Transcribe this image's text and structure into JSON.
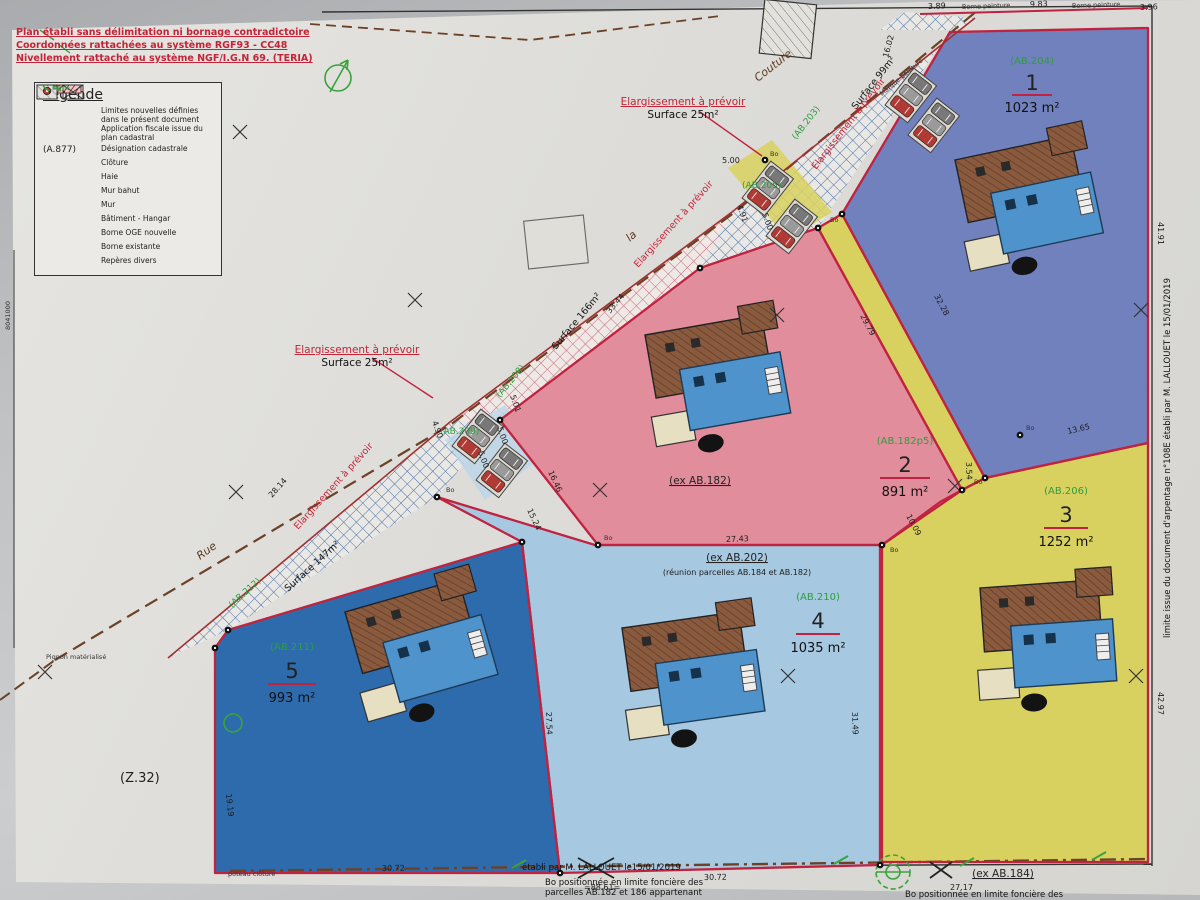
{
  "notes": {
    "line1": "Plan établi sans délimitation ni bornage contradictoire",
    "line2": "Coordonnées rattachées au système RGF93  -  CC48",
    "line3": "Nivellement rattaché au système NGF/I.G.N 69. (TERIA)"
  },
  "legend": {
    "title": "Légende",
    "items": [
      {
        "label": "Limites nouvelles définies dans le présent document"
      },
      {
        "label": "Application fiscale issue du plan cadastral"
      },
      {
        "label": "Désignation cadastrale",
        "sym": "(A.877)"
      },
      {
        "label": "Clôture"
      },
      {
        "label": "Haie"
      },
      {
        "label": "Mur bahut"
      },
      {
        "label": "Mur"
      },
      {
        "label": "Bâtiment - Hangar"
      },
      {
        "label": "Borne OGE nouvelle",
        "tag": "Bo"
      },
      {
        "label": "Borne existante",
        "tag": "Borne"
      },
      {
        "label": "Repères divers"
      }
    ]
  },
  "ann_top": {
    "line1": "Elargissement à prévoir",
    "line2": "Surface 25m²"
  },
  "ann_left": {
    "line1": "Elargissement à prévoir",
    "line2": "Surface 25m²"
  },
  "parcels": [
    {
      "ref": "(AB.204)",
      "num": "1",
      "area": "1023 m²"
    },
    {
      "ref": "(AB.182p5)",
      "num": "2",
      "area": "891 m²"
    },
    {
      "ref": "(AB.206)",
      "num": "3",
      "area": "1252 m²"
    },
    {
      "ref": "(AB.210)",
      "num": "4",
      "area": "1035 m²"
    },
    {
      "ref": "(AB.211)",
      "num": "5",
      "area": "993 m²"
    }
  ],
  "ex": {
    "ab182": "(ex AB.182)",
    "ab202": "(ex AB.202)",
    "ab202b": "(réunion parcelles AB.184 et AB.182)",
    "ab184": "(ex AB.184)"
  },
  "zone_label": "(Z.32)",
  "side_note": "limite issue du document d'arpentage n°108E établi par M. LALLOUET le 15/01/2019",
  "bottom": {
    "strike": "établi par M. LALLOUET le15/01/2019",
    "note1a": "Bo positionnée en limite foncière des",
    "note1b": "parcelles AB.182 et 186 appartenant",
    "note2": "Bo positionnée en limite foncière des"
  },
  "colors": {
    "parcel1": "#7081bd",
    "parcel2": "#e18d9c",
    "parcel3": "#d9d15f",
    "parcel4": "#a6c8e0",
    "parcel5": "#2e6bac",
    "new_limit_red": "#bf2340",
    "green_ref": "#2e9e3e",
    "road_brown": "#6b4226"
  },
  "labels": [
    {
      "t": "3.89",
      "x": 928,
      "y": 9,
      "r": -2,
      "c": "d"
    },
    {
      "t": "9.83",
      "x": 1030,
      "y": 7,
      "r": -2,
      "c": "d"
    },
    {
      "t": "3.96",
      "x": 1140,
      "y": 10,
      "r": -2,
      "c": "d"
    },
    {
      "t": "Borne peinture",
      "x": 962,
      "y": 9,
      "r": -2,
      "c": "t"
    },
    {
      "t": "Borne peinture",
      "x": 1072,
      "y": 8,
      "r": -2,
      "c": "t"
    },
    {
      "t": "16.02",
      "x": 888,
      "y": 58,
      "r": -75,
      "c": "d"
    },
    {
      "t": "41.91",
      "x": 1158,
      "y": 222,
      "r": 90,
      "c": "d"
    },
    {
      "t": "Marque peinture",
      "x": 882,
      "y": 96,
      "r": -40,
      "c": "t"
    },
    {
      "t": "Surface 99m²",
      "x": 856,
      "y": 110,
      "r": -52,
      "c": "s"
    },
    {
      "t": "(AB.203)",
      "x": 796,
      "y": 140,
      "r": -52,
      "c": "g"
    },
    {
      "t": "Elargissement à prévoir",
      "x": 816,
      "y": 170,
      "r": -52,
      "c": "r"
    },
    {
      "t": "(AB.205)",
      "x": 742,
      "y": 188,
      "r": 0,
      "c": "g"
    },
    {
      "t": "5.00",
      "x": 722,
      "y": 163,
      "r": 0,
      "c": "d"
    },
    {
      "t": "4.91",
      "x": 737,
      "y": 206,
      "r": 70,
      "c": "d"
    },
    {
      "t": "5.00",
      "x": 762,
      "y": 214,
      "r": 70,
      "c": "d"
    },
    {
      "t": "Couture",
      "x": 758,
      "y": 82,
      "r": -38,
      "c": "b"
    },
    {
      "t": "la",
      "x": 630,
      "y": 242,
      "r": -42,
      "c": "b"
    },
    {
      "t": "Rue",
      "x": 200,
      "y": 560,
      "r": -36,
      "c": "b"
    },
    {
      "t": "Elargissement à prévoir",
      "x": 638,
      "y": 268,
      "r": -48,
      "c": "r"
    },
    {
      "t": "33.44",
      "x": 610,
      "y": 314,
      "r": -50,
      "c": "d"
    },
    {
      "t": "Surface 166m²",
      "x": 556,
      "y": 350,
      "r": -50,
      "c": "s"
    },
    {
      "t": "(AB.208)",
      "x": 500,
      "y": 398,
      "r": -50,
      "c": "g"
    },
    {
      "t": "5.01",
      "x": 510,
      "y": 396,
      "r": 70,
      "c": "d"
    },
    {
      "t": "5.00",
      "x": 497,
      "y": 428,
      "r": 70,
      "c": "d"
    },
    {
      "t": "(AB.209)",
      "x": 440,
      "y": 434,
      "r": 0,
      "c": "g"
    },
    {
      "t": "4.90",
      "x": 432,
      "y": 422,
      "r": 70,
      "c": "d"
    },
    {
      "t": "5.00",
      "x": 478,
      "y": 452,
      "r": 70,
      "c": "d"
    },
    {
      "t": "28.14",
      "x": 272,
      "y": 498,
      "r": -48,
      "c": "d"
    },
    {
      "t": "Elargissement à prévoir",
      "x": 298,
      "y": 530,
      "r": -48,
      "c": "r"
    },
    {
      "t": "Surface 147m²",
      "x": 288,
      "y": 592,
      "r": -42,
      "c": "s"
    },
    {
      "t": "(AB.212)",
      "x": 232,
      "y": 608,
      "r": -42,
      "c": "g"
    },
    {
      "t": "16.46",
      "x": 548,
      "y": 472,
      "r": 65,
      "c": "d"
    },
    {
      "t": "15.24",
      "x": 527,
      "y": 510,
      "r": 65,
      "c": "d"
    },
    {
      "t": "29.79",
      "x": 860,
      "y": 316,
      "r": 62,
      "c": "d"
    },
    {
      "t": "32.28",
      "x": 934,
      "y": 296,
      "r": 62,
      "c": "d"
    },
    {
      "t": "3.54",
      "x": 966,
      "y": 462,
      "r": 88,
      "c": "d"
    },
    {
      "t": "10.09",
      "x": 906,
      "y": 516,
      "r": 62,
      "c": "d"
    },
    {
      "t": "13.65",
      "x": 1068,
      "y": 434,
      "r": -13,
      "c": "d"
    },
    {
      "t": "27.43",
      "x": 726,
      "y": 542,
      "r": -2,
      "c": "d"
    },
    {
      "t": "31.49",
      "x": 852,
      "y": 712,
      "r": 88,
      "c": "d"
    },
    {
      "t": "27.54",
      "x": 546,
      "y": 712,
      "r": 88,
      "c": "d"
    },
    {
      "t": "42.97",
      "x": 1158,
      "y": 692,
      "r": 90,
      "c": "d"
    },
    {
      "t": "19.19",
      "x": 226,
      "y": 794,
      "r": 84,
      "c": "d"
    },
    {
      "t": "30.72",
      "x": 382,
      "y": 871,
      "r": -1,
      "c": "d"
    },
    {
      "t": "30.72",
      "x": 704,
      "y": 880,
      "r": -1,
      "c": "d"
    },
    {
      "t": "=88.61=",
      "x": 584,
      "y": 890,
      "r": 0,
      "c": "d"
    },
    {
      "t": "27.17",
      "x": 950,
      "y": 890,
      "r": 0,
      "c": "d"
    },
    {
      "t": "Pignon matérialisé",
      "x": 46,
      "y": 659,
      "r": 0,
      "c": "t"
    },
    {
      "t": "poteau clôture",
      "x": 228,
      "y": 876,
      "r": 0,
      "c": "t"
    },
    {
      "t": "8041000",
      "x": 10,
      "y": 330,
      "r": -90,
      "c": "t"
    },
    {
      "t": "Bo",
      "x": 830,
      "y": 222,
      "r": 0,
      "c": "t"
    },
    {
      "t": "Bo",
      "x": 974,
      "y": 484,
      "r": 0,
      "c": "t"
    },
    {
      "t": "Bo",
      "x": 890,
      "y": 552,
      "r": 0,
      "c": "t"
    },
    {
      "t": "Bo",
      "x": 604,
      "y": 540,
      "r": 0,
      "c": "t"
    },
    {
      "t": "Bo",
      "x": 446,
      "y": 492,
      "r": 0,
      "c": "t"
    },
    {
      "t": "Bo",
      "x": 1026,
      "y": 430,
      "r": 0,
      "c": "t"
    },
    {
      "t": "Bo",
      "x": 770,
      "y": 156,
      "r": 0,
      "c": "t"
    }
  ],
  "grid_crosses": [
    {
      "x": 240,
      "y": 132
    },
    {
      "x": 415,
      "y": 300
    },
    {
      "x": 236,
      "y": 492
    },
    {
      "x": 45,
      "y": 672
    },
    {
      "x": 600,
      "y": 490
    },
    {
      "x": 777,
      "y": 315
    },
    {
      "x": 788,
      "y": 676
    },
    {
      "x": 955,
      "y": 486
    },
    {
      "x": 1141,
      "y": 310
    },
    {
      "x": 1136,
      "y": 676
    }
  ],
  "bo_dots": [
    {
      "x": 765,
      "y": 160
    },
    {
      "x": 818,
      "y": 228
    },
    {
      "x": 842,
      "y": 214
    },
    {
      "x": 962,
      "y": 490
    },
    {
      "x": 985,
      "y": 478
    },
    {
      "x": 882,
      "y": 545
    },
    {
      "x": 598,
      "y": 545
    },
    {
      "x": 500,
      "y": 420
    },
    {
      "x": 437,
      "y": 497
    },
    {
      "x": 522,
      "y": 542
    },
    {
      "x": 560,
      "y": 873
    },
    {
      "x": 880,
      "y": 865
    },
    {
      "x": 1020,
      "y": 435
    },
    {
      "x": 700,
      "y": 268
    },
    {
      "x": 228,
      "y": 630
    },
    {
      "x": 215,
      "y": 648
    }
  ]
}
